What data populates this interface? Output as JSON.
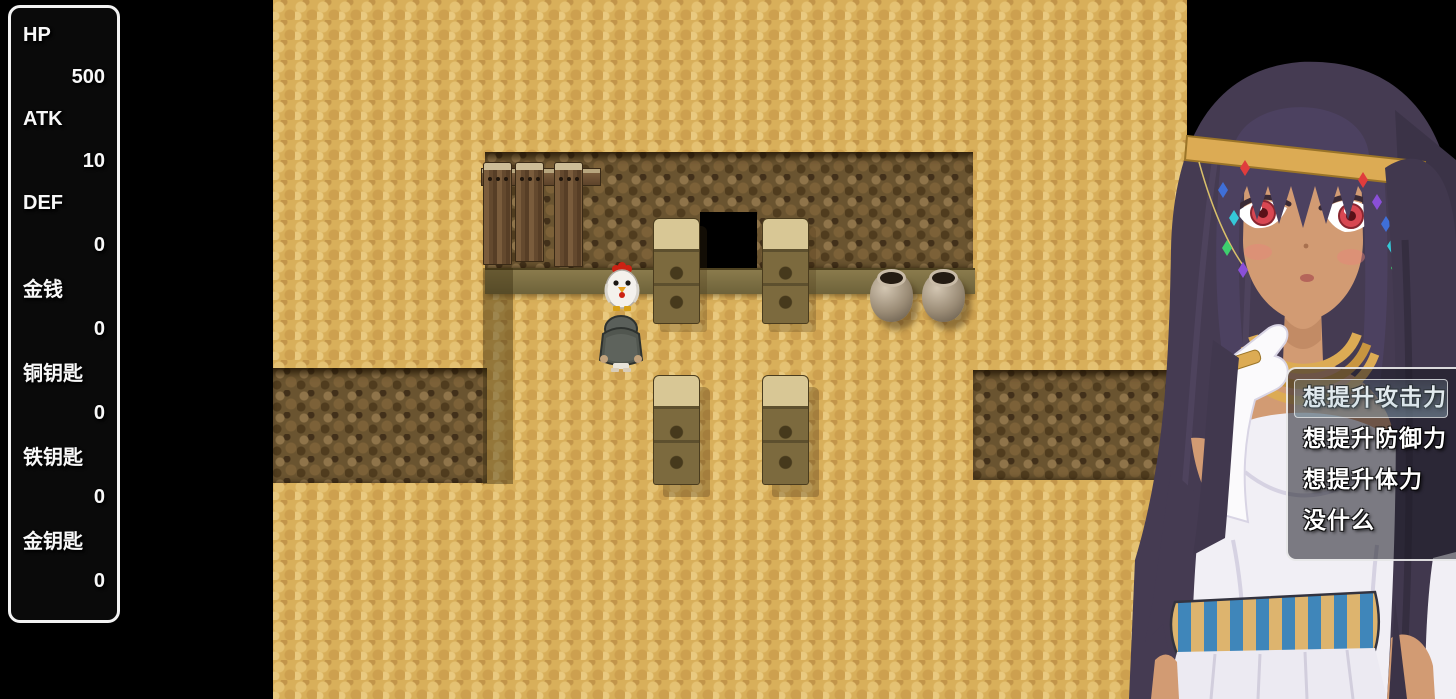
{
  "stats_panel": {
    "items": [
      {
        "label": "HP",
        "value": "500"
      },
      {
        "label": "ATK",
        "value": "10"
      },
      {
        "label": "DEF",
        "value": "0"
      },
      {
        "label": "金钱",
        "value": "0"
      },
      {
        "label": "铜钥匙",
        "value": "0"
      },
      {
        "label": "铁钥匙",
        "value": "0"
      },
      {
        "label": "金钥匙",
        "value": "0"
      }
    ]
  },
  "choice_menu": {
    "items": [
      {
        "label": "想提升攻击力",
        "selected": true
      },
      {
        "label": "想提升防御力",
        "selected": false
      },
      {
        "label": "想提升体力",
        "selected": false
      },
      {
        "label": "没什么",
        "selected": false
      }
    ]
  },
  "scene": {
    "sprites": {
      "chicken": "chicken-sprite",
      "player": "hooded-player-sprite",
      "pot": "clay-pot",
      "pillar": "stone-pillar",
      "doorway": "dark-doorway",
      "planks": "wooden-boards",
      "npc": "egyptian-girl-portrait"
    },
    "counts": {
      "pots": 2,
      "upper_pillars": 2,
      "lower_pillars": 2,
      "planks": 3
    }
  },
  "colors": {
    "sand": "#d8af5a",
    "rock": "#6a5430",
    "ledge": "#7c7044",
    "panel_border": "#f2f2f2",
    "menu_bg": "rgba(25,25,35,0.55)",
    "menu_border": "#fafafa",
    "selection_highlight": "rgba(150,180,195,0.4)",
    "hair": "#453b52",
    "skin": "#d29b73",
    "gold": "#dcab54",
    "belt_blue": "#3f86ba",
    "belt_tan": "#ddb46e"
  }
}
